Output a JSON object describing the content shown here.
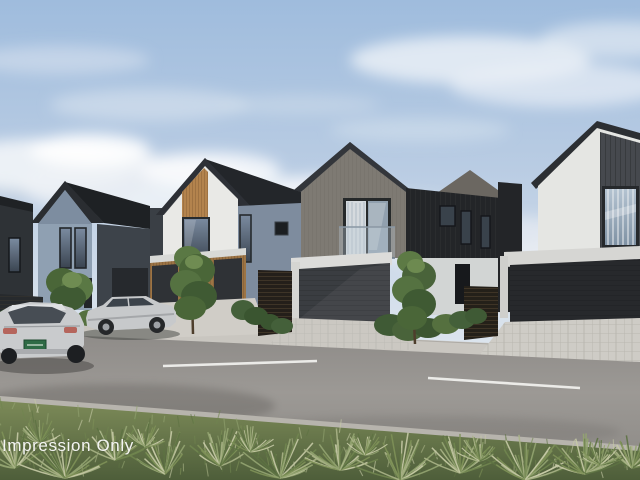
{
  "watermark": {
    "text": "Impression Only",
    "color": "#f4f5f3"
  },
  "palette": {
    "sky_top": "#9fbcdd",
    "sky_horizon": "#edf0f3",
    "cloud_white": "#f2f5f8",
    "roof_dark": "#2a2d31",
    "house_white": "#e8e9e6",
    "house_grey_blue": "#8fa0b2",
    "house_taupe": "#7e7a73",
    "house_black_cladding": "#232528",
    "timber_accent": "#b3834d",
    "garage_door_dark": "#35383c",
    "road_asphalt": "#969390",
    "road_marking": "#f3f3f0",
    "footpath_concrete": "#c9c6c0",
    "kerb": "#b7b4ad",
    "grass_green": "#6d8050",
    "tussock_pale": "#c6caa6",
    "foliage_dark": "#3f5a33",
    "car_silver": "#c7c9cb",
    "licence_plate_green": "#2f6b45"
  }
}
